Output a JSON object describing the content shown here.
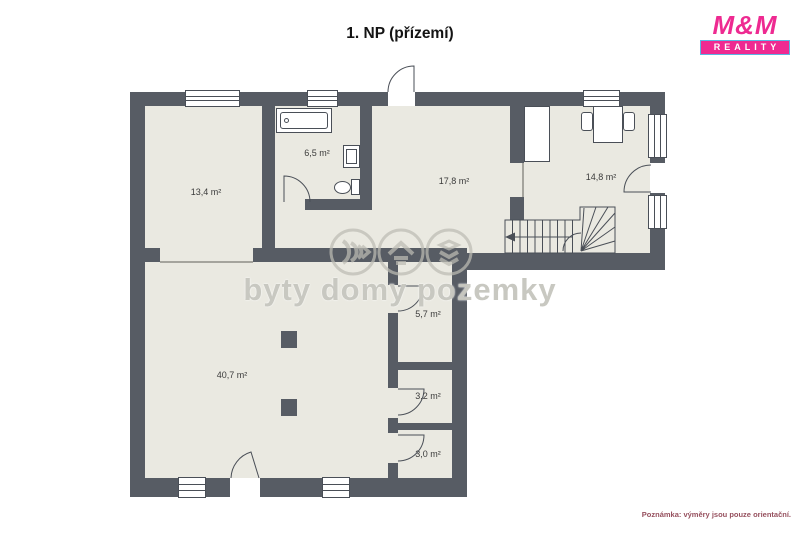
{
  "title": "1. NP (přízemí)",
  "logo": {
    "name": "M&M",
    "subtitle": "REALITY"
  },
  "note": "Poznámka: výměry jsou pouze orientační.",
  "watermark": {
    "text": "byty domy pozemky",
    "icons": [
      "sound-waves-icon",
      "house-icon",
      "stacked-layers-icon"
    ]
  },
  "rooms": [
    {
      "label": "13,4 m²"
    },
    {
      "label": "6,5 m²"
    },
    {
      "label": "17,8 m²"
    },
    {
      "label": "14,8 m²"
    },
    {
      "label": "40,7 m²"
    },
    {
      "label": "5,7 m²"
    },
    {
      "label": "3,2 m²"
    },
    {
      "label": "3,0 m²"
    }
  ],
  "colors": {
    "wall": "#575c64",
    "floor": "#eae9e1",
    "brand_pink": "#ee2a91",
    "brand_blue": "#5ab5e3",
    "note_text": "#96505e"
  }
}
